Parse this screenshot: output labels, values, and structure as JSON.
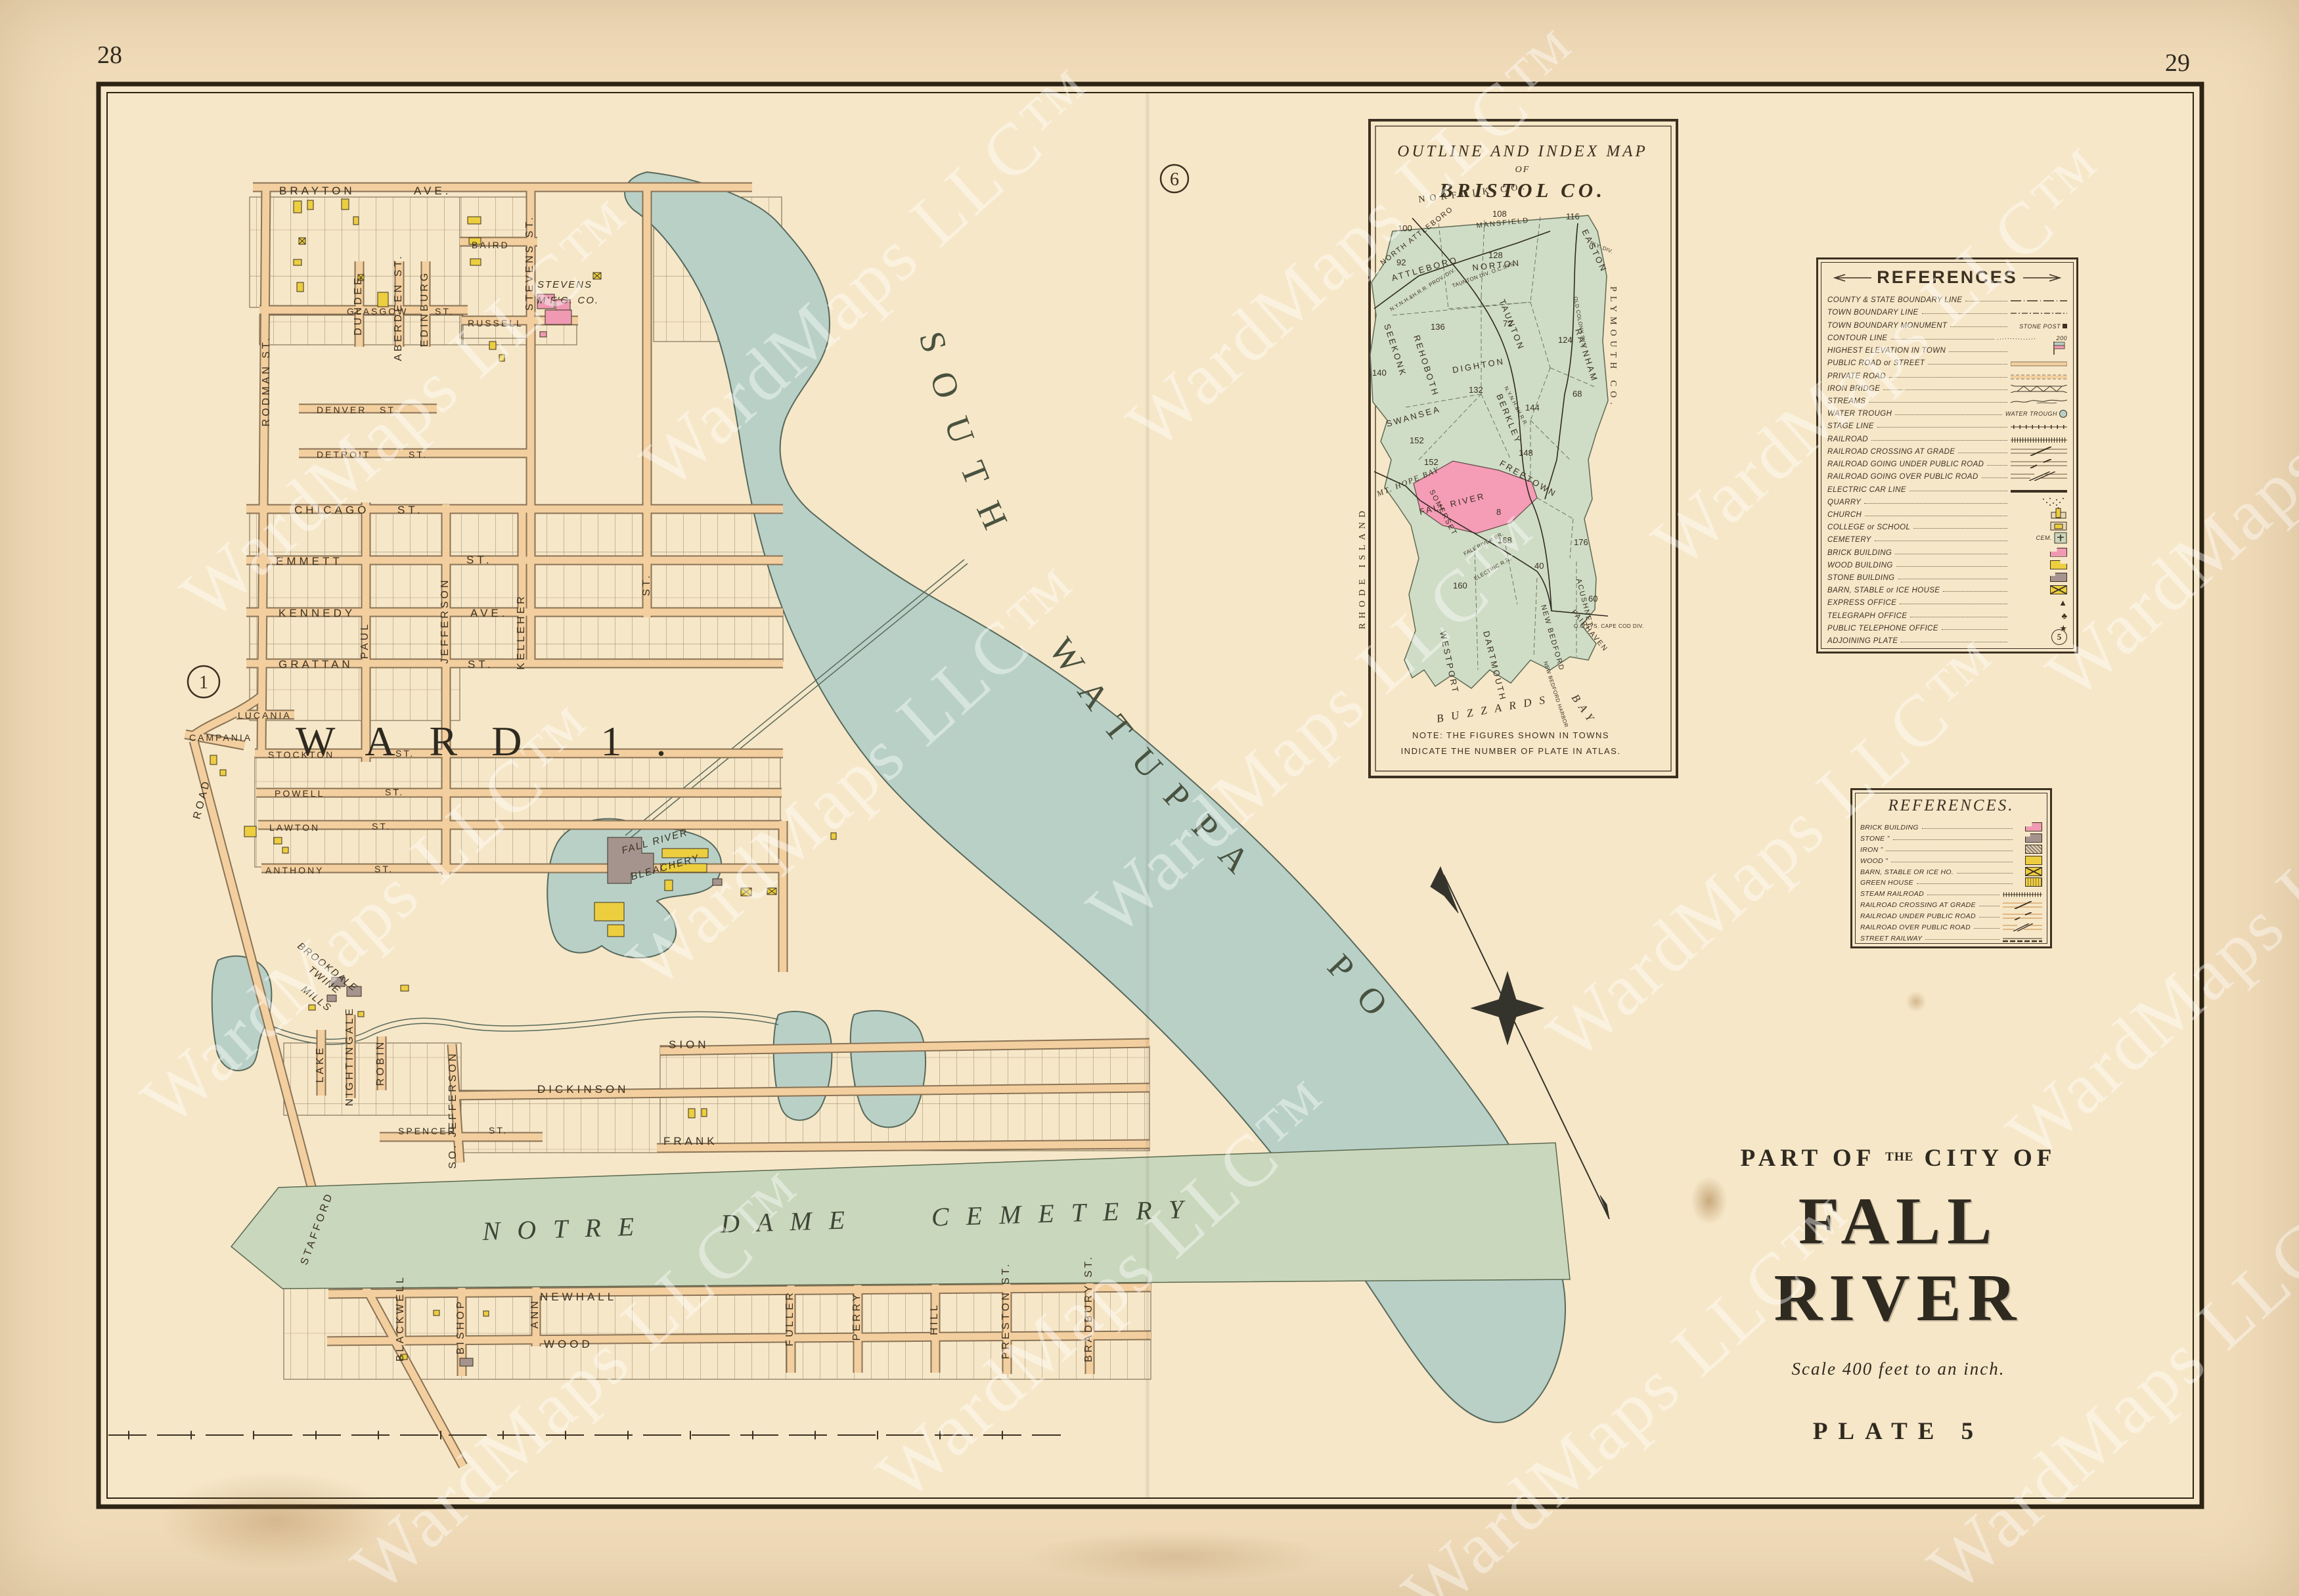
{
  "page": {
    "left_number": "28",
    "right_number": "29",
    "watermark": "WardMaps LLC™"
  },
  "title_block": {
    "part_of": "PART OF",
    "the": "THE",
    "city_of": "CITY OF",
    "city": "FALL RIVER",
    "scale": "Scale 400 feet to an inch.",
    "plate": "PLATE 5"
  },
  "main_map": {
    "ward_label": "WARD 1.",
    "pond_label": "SOUTH WATUPPA POND",
    "cemetery_label": "NOTRE DAME CEMETERY",
    "plate_circle_left": "1",
    "plate_circle_top": "6",
    "landmarks": {
      "stevens1": "STEVENS",
      "stevens2": "M'F'G. CO.",
      "bleach1": "FALL RIVER",
      "bleach2": "BLEACHERY",
      "brook1": "BROOKDALE",
      "brook2": "TWINE",
      "brook3": "MILLS"
    },
    "streets": {
      "brayton": "BRAYTON",
      "brayton_sfx": "AVE.",
      "baird": "BAIRD",
      "russell": "RUSSELL",
      "glasgow": "GLASGOW",
      "glasgow_sfx": "ST.",
      "denver": "DENVER",
      "denver_sfx": "ST.",
      "detroit": "DETROIT",
      "detroit_sfx": "ST.",
      "chicago": "CHICAGO",
      "chicago_sfx": "ST.",
      "emmett": "EMMETT",
      "emmett_sfx": "ST.",
      "kennedy": "KENNEDY",
      "kennedy_sfx": "AVE.",
      "grattan": "GRATTAN",
      "grattan_sfx": "ST.",
      "lucania": "LUCANIA",
      "campania": "CAMPANIA",
      "stockton": "STOCKTON",
      "stockton_sfx": "ST.",
      "powell": "POWELL",
      "powell_sfx": "ST.",
      "lawton": "LAWTON",
      "lawton_sfx": "ST.",
      "anthony": "ANTHONY",
      "anthony_sfx": "ST.",
      "sion": "SION",
      "dickinson": "DICKINSON",
      "spencer": "SPENCER",
      "spencer_sfx": "ST.",
      "frank": "FRANK",
      "newhall": "NEWHALL",
      "wood": "WOOD",
      "rodman": "RODMAN ST.",
      "dundee": "DUNDEE",
      "aberdeen": "ABERDEEN ST.",
      "edinburg": "EDINBURG",
      "stevens": "STEVENS ST.",
      "paul": "PAUL",
      "jefferson": "JEFFERSON",
      "kelleher": "KELLEHER",
      "st_only": "ST.",
      "so_jefferson": "SO. JEFFERSON",
      "lake": "LAKE",
      "nightingale": "NIGHTINGALE",
      "robin": "ROBIN",
      "blackwell": "BLACKWELL",
      "bishop": "BISHOP",
      "ann": "ANN",
      "fuller": "FULLER",
      "perry": "PERRY",
      "hill": "HILL",
      "preston": "PRESTON ST.",
      "bradbury": "BRADBURY ST.",
      "stafford": "STAFFORD",
      "stafford_sfx": "ROAD"
    }
  },
  "inset": {
    "title1": "OUTLINE AND INDEX MAP",
    "title2": "OF",
    "title3": "BRISTOL CO.",
    "note1": "NOTE: THE FIGURES SHOWN IN TOWNS",
    "note2": "INDICATE THE NUMBER OF PLATE IN ATLAS.",
    "regions": [
      {
        "name": "NORTH ATTLEBORO",
        "plate": "100"
      },
      {
        "name": "ATTLEBORO",
        "plate": "92"
      },
      {
        "name": "MANSFIELD",
        "plate": "108"
      },
      {
        "name": "NORTON",
        "plate": "128"
      },
      {
        "name": "EASTON",
        "plate": "116"
      },
      {
        "name": "SEEKONK",
        "plate": "140"
      },
      {
        "name": "REHOBOTH",
        "plate": "136"
      },
      {
        "name": "TAUNTON",
        "plate": "72"
      },
      {
        "name": "RAYNHAM",
        "plate": "124"
      },
      {
        "name": "DIGHTON",
        "plate": "132"
      },
      {
        "name": "BERKLEY",
        "plate": "144"
      },
      {
        "name": "SWANSEA",
        "plate": "152"
      },
      {
        "name": "SOMERSET",
        "plate": "152"
      },
      {
        "name": "FREETOWN",
        "plate": "148"
      },
      {
        "name": "FALL RIVER",
        "plate": "8"
      },
      {
        "name": "WESTPORT",
        "plate": "160"
      },
      {
        "name": "DARTMOUTH",
        "plate": "168"
      },
      {
        "name": "NEW BEDFORD",
        "plate": "40"
      },
      {
        "name": "ACUSHNET",
        "plate": "176"
      },
      {
        "name": "FAIRHAVEN",
        "plate": "60"
      },
      {
        "name": "",
        "plate": "68"
      }
    ],
    "geo": {
      "norfolk": "NORFOLK CO.",
      "plymouth": "PLYMOUTH CO.",
      "rhode_island": "RHODE ISLAND",
      "mt_hope": "MT. HOPE BAY",
      "buzzards1": "BUZZARDS",
      "buzzards2": "BAY",
      "nb_harbor": "NEW BEDFORD HARBOR"
    },
    "railroads": [
      "N.Y.N.H.&H.R.R. PROV. DIV.",
      "TAUNTON DIV. O.C.SYS.",
      "OLD COLONY SYS.",
      "N.Y.N.H.&H.R.R.",
      "FALL RIVER BR.",
      "ELECTRIC R.R.",
      "O.C.SYS. CAPE COD DIV.",
      "PLY. DIV."
    ]
  },
  "references_main": {
    "title": "REFERENCES",
    "items": [
      {
        "label": "COUNTY & STATE BOUNDARY LINE"
      },
      {
        "label": "TOWN BOUNDARY LINE"
      },
      {
        "label": "TOWN BOUNDARY MONUMENT",
        "note": "STONE POST"
      },
      {
        "label": "CONTOUR LINE",
        "note": "200"
      },
      {
        "label": "HIGHEST ELEVATION IN TOWN"
      },
      {
        "label": "PUBLIC ROAD or STREET"
      },
      {
        "label": "PRIVATE ROAD"
      },
      {
        "label": "IRON BRIDGE"
      },
      {
        "label": "STREAMS"
      },
      {
        "label": "WATER TROUGH",
        "note": "WATER TROUGH"
      },
      {
        "label": "STAGE LINE"
      },
      {
        "label": "RAILROAD"
      },
      {
        "label": "RAILROAD CROSSING AT GRADE"
      },
      {
        "label": "RAILROAD GOING UNDER PUBLIC ROAD"
      },
      {
        "label": "RAILROAD GOING OVER PUBLIC ROAD"
      },
      {
        "label": "ELECTRIC CAR LINE"
      },
      {
        "label": "QUARRY"
      },
      {
        "label": "CHURCH"
      },
      {
        "label": "COLLEGE or SCHOOL"
      },
      {
        "label": "CEMETERY",
        "note": "CEM."
      },
      {
        "label": "BRICK BUILDING"
      },
      {
        "label": "WOOD BUILDING"
      },
      {
        "label": "STONE BUILDING"
      },
      {
        "label": "BARN, STABLE or ICE HOUSE"
      },
      {
        "label": "EXPRESS OFFICE"
      },
      {
        "label": "TELEGRAPH OFFICE"
      },
      {
        "label": "PUBLIC TELEPHONE OFFICE"
      },
      {
        "label": "ADJOINING PLATE",
        "note": "5"
      }
    ]
  },
  "references_small": {
    "title": "REFERENCES.",
    "items": [
      {
        "label": "BRICK BUILDING"
      },
      {
        "label": "STONE  ”"
      },
      {
        "label": "IRON  ”"
      },
      {
        "label": "WOOD  ”"
      },
      {
        "label": "BARN, STABLE OR ICE HO."
      },
      {
        "label": "GREEN HOUSE"
      },
      {
        "label": "STEAM RAILROAD"
      },
      {
        "label": "RAILROAD CROSSING AT GRADE"
      },
      {
        "label": "RAILROAD UNDER PUBLIC ROAD"
      },
      {
        "label": "RAILROAD OVER PUBLIC ROAD"
      },
      {
        "label": "STREET RAILWAY"
      }
    ]
  },
  "colors": {
    "paper": "#f1dcba",
    "paper_light": "#f6e7c8",
    "ink": "#3c3122",
    "water": "#b9d0c7",
    "cemetery_green": "#c9d7bc",
    "inset_green": "#cfdcc6",
    "road_fill": "#f3cf9f",
    "road_casing": "#8a7356",
    "brick_pink": "#ef9ab2",
    "wood_yellow": "#ecce3f",
    "stone_gray": "#a5948d",
    "fall_river_pink": "#f59cb6"
  }
}
